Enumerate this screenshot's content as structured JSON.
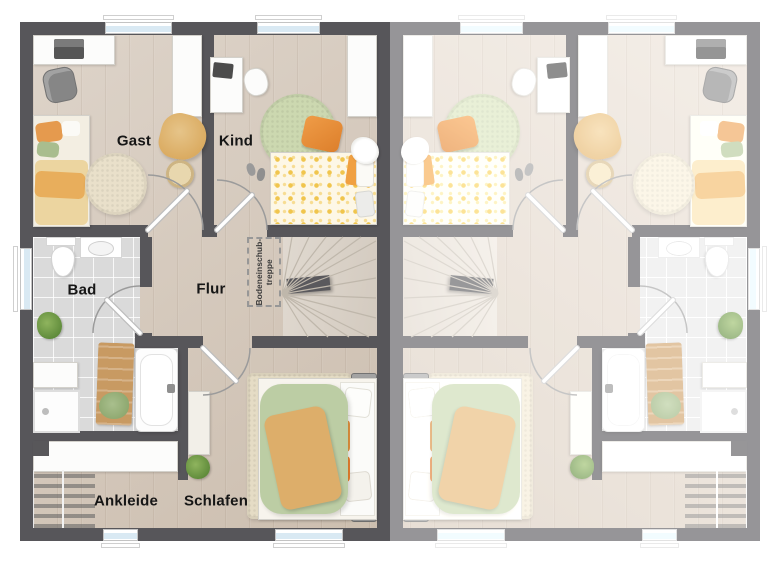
{
  "plan": {
    "description_labels": {
      "gast": "Gast",
      "kind": "Kind",
      "bad": "Bad",
      "flur": "Flur",
      "ankleide": "Ankleide",
      "schlafen": "Schlafen"
    },
    "attic_hatch": {
      "line1": "Bodeneinschub-",
      "line2": "treppe"
    },
    "colors": {
      "wall_left_unit": "#57565a",
      "wall_right_unit_faded": "#9e9e9e",
      "floor_wood": "#d2c5b7",
      "floor_tile": "#dadada",
      "stair_tread": "#d9d1c7",
      "window_glass": "#d9e9f3",
      "accent_orange": "#e2913f",
      "rug_green": "#ccd8b0",
      "duvet_green": "#bccda4",
      "throw_tan": "#ddae6a",
      "rug_cream": "#e9e0ca",
      "label_text": "#161616",
      "background": "#ffffff"
    }
  }
}
